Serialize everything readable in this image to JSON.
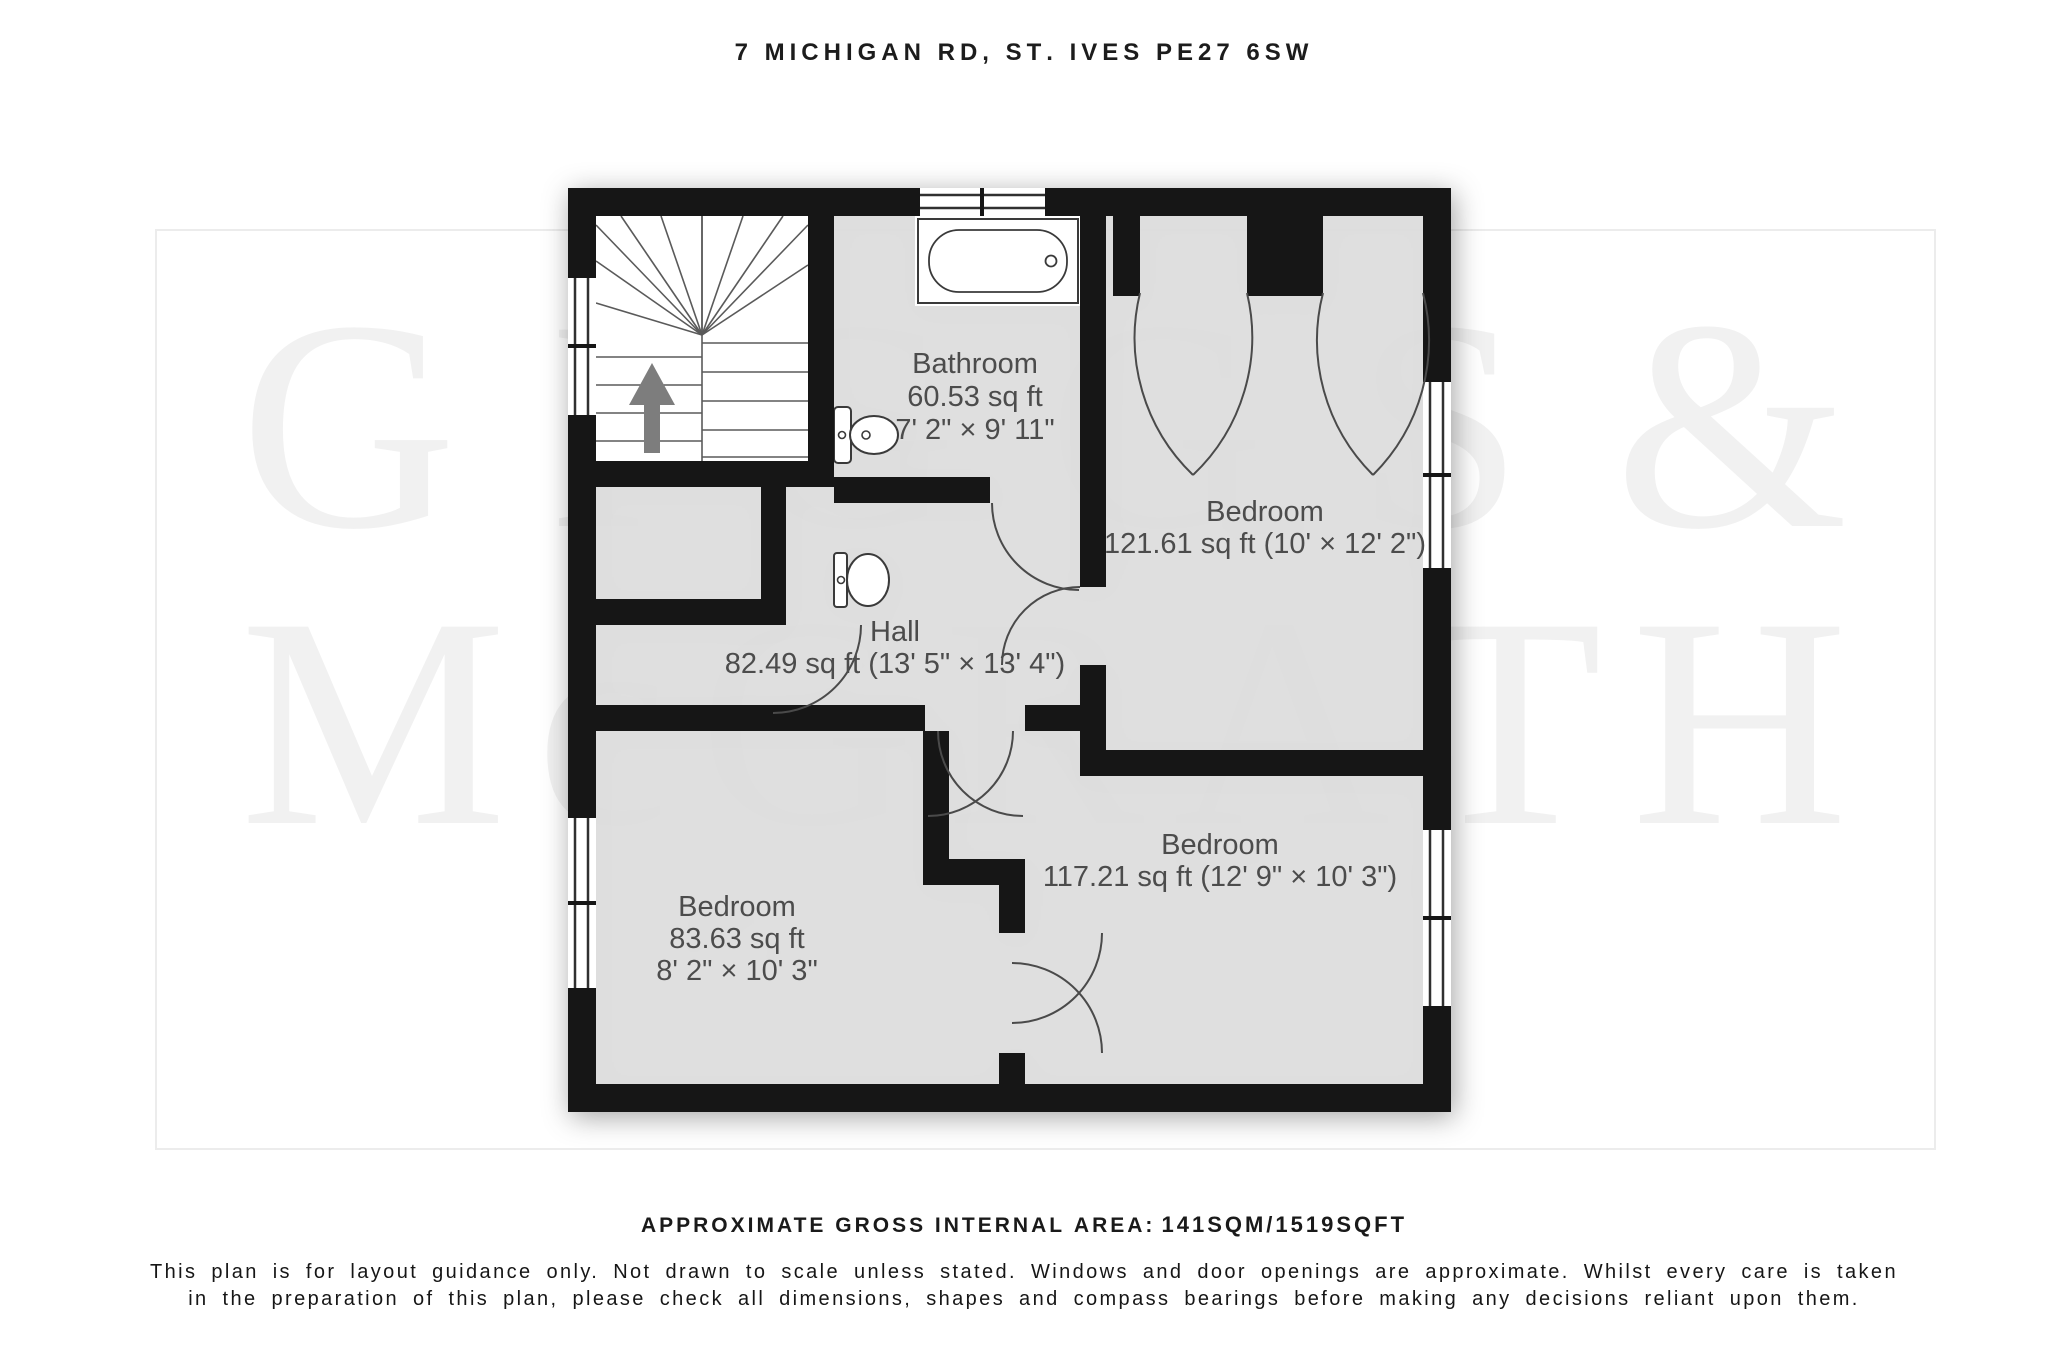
{
  "title": "7 Michigan Rd, St. Ives PE27 6SW",
  "watermark": {
    "line1": "GIGGS &",
    "line2": "McGRATH"
  },
  "rooms": {
    "bathroom": {
      "name": "Bathroom",
      "area": "60.53 sq ft",
      "dims": "7' 2\" × 9' 11\""
    },
    "bedroom_top_right": {
      "name": "Bedroom",
      "area_dims": "121.61 sq ft (10' × 12' 2\")"
    },
    "hall": {
      "name": "Hall",
      "area_dims": "82.49 sq ft (13' 5\" × 13' 4\")"
    },
    "bedroom_bottom_right": {
      "name": "Bedroom",
      "area_dims": "117.21 sq ft (12' 9\" × 10' 3\")"
    },
    "bedroom_bottom_left": {
      "name": "Bedroom",
      "area": "83.63 sq ft",
      "dims": "8' 2\" × 10' 3\""
    }
  },
  "footer": {
    "area_label": "approximate gross internal area:",
    "area_value": "141sqm/1519sqft",
    "disclaimer_line1": "This plan is for layout guidance only. Not drawn to scale unless stated. Windows and door openings are approximate. Whilst every care is taken",
    "disclaimer_line2": "in the preparation of this plan, please check all dimensions, shapes and compass bearings before making any decisions reliant upon them."
  }
}
